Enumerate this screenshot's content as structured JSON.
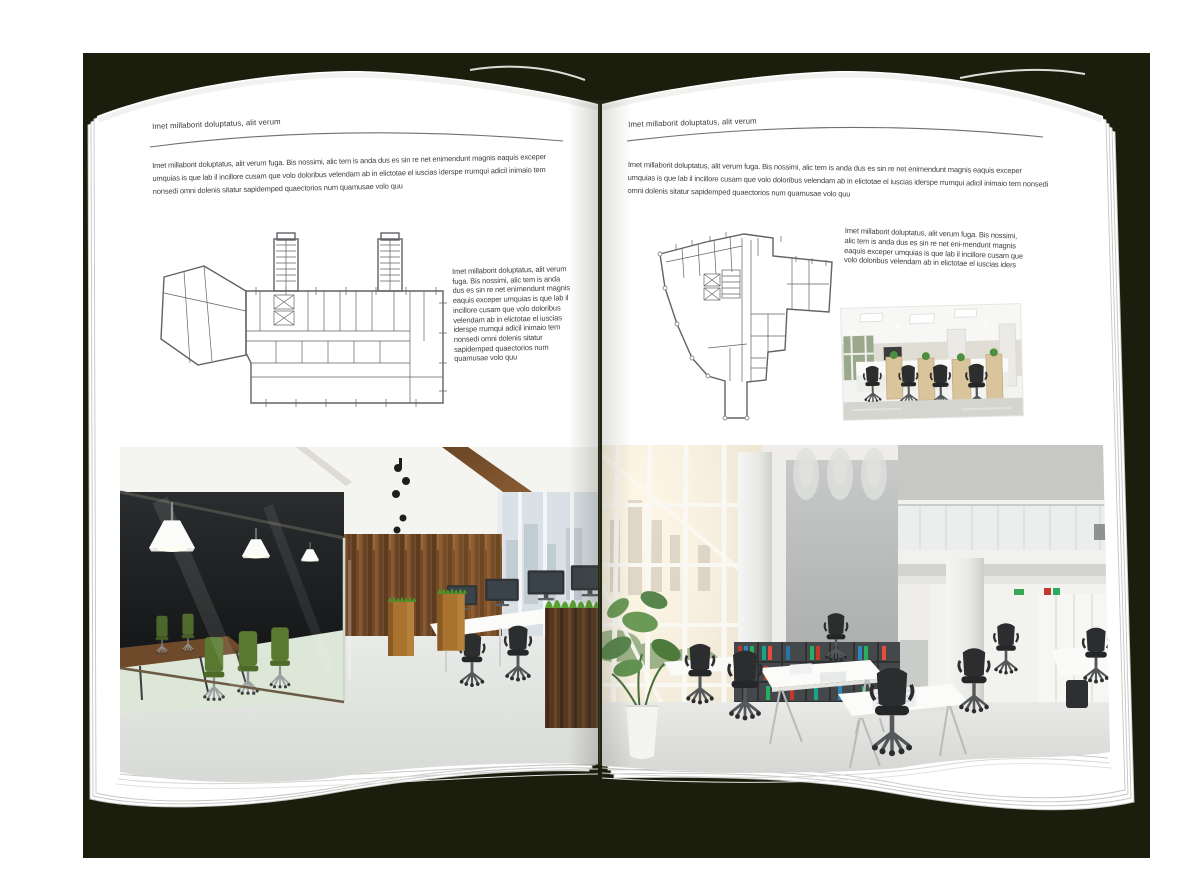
{
  "colors": {
    "backdrop": "#1c1e0d",
    "page": "#ffffff",
    "text-ink": "#3f3f3f",
    "rule": "#6f6f6f",
    "plan-ink": "#54555a"
  },
  "pages": {
    "left": {
      "header": "Imet millaborit doluptatus, alit verum",
      "intro": "Imet millaborit doluptatus, alit verum fuga. Bis nossimi, alic tem is anda dus es sin re net enimendunt magnis eaquis exceper umquias is que lab il incillore cusam que volo doloribus velendam ab in elictotae el iuscias iderspe rrumqui adicil inimaio tem nonsedi omni dolenis sitatur sapidemped quaectorios num quamusae volo quu",
      "side_text": "Imet millaborit doluptatus, alit verum fuga. Bis nossimi, alic tem is anda dus es sin re net enimendunt magnis eaquis exceper umquias is que lab il incillore cusam que volo doloribus velendam ab in elictotae el iuscias iderspe rrumqui adicil inimaio tem nonsedi omni dolenis sitatur sapidemped quaectorios num quamusae volo quu"
    },
    "right": {
      "header": "Imet millaborit doluptatus, alit verum",
      "intro": "Imet millaborit doluptatus, alit verum fuga. Bis nossimi, alic tem is anda dus es sin re net enimendunt magnis eaquis exceper umquias is que lab il incillore cusam que volo doloribus velendam ab in elictotae el iuscias iderspe rrumqui adicil inimaio tem nonsedi omni dolenis sitatur sapidemped quaectorios num quamusae volo quu",
      "side_text": "Imet millaborit doluptatus, alit verum fuga. Bis nossimi, alic tem is anda dus es sin re net eni-mendunt magnis eaquis exceper umquias is que lab il incillore cusam que volo doloribus velendam ab in elictotae el iuscias iders"
    }
  }
}
